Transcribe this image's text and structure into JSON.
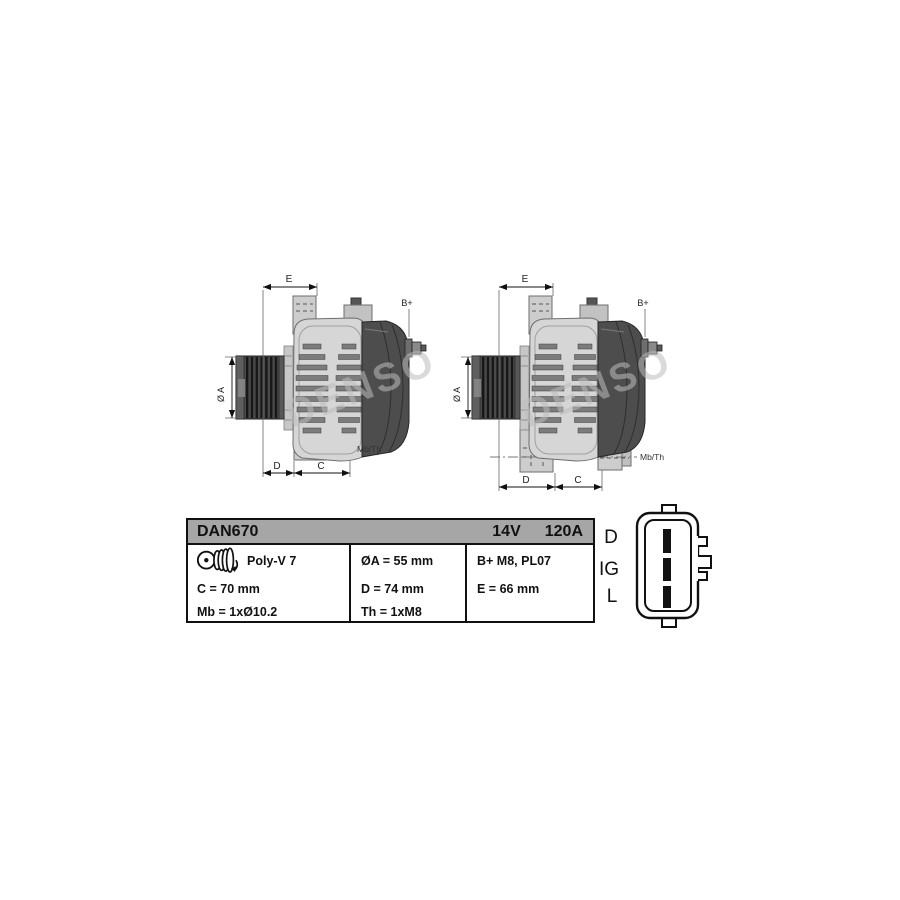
{
  "drawing_labels": {
    "e": "E",
    "d": "D",
    "c": "C",
    "dia": "Ø A",
    "bplus": "B+",
    "mbth": "Mb/Th",
    "watermark": "DENSO"
  },
  "table": {
    "part_number": "DAN670",
    "voltage": "14V",
    "amperage": "120A",
    "pulley_type": "Poly-V 7",
    "cells": {
      "oa": "ØA = 55 mm",
      "c": "C = 70 mm",
      "d": "D = 74 mm",
      "e": "E = 66 mm",
      "mb": "Mb = 1xØ10.2",
      "th": "Th = 1xM8",
      "bplus": "B+ M8, PL07"
    }
  },
  "connector": {
    "pin_labels": [
      "D",
      "IG",
      "L"
    ]
  },
  "colors": {
    "table_header_bg": "#a6a6a6",
    "drawing_body_gray": "#d6d6d6",
    "rear_cover_gray": "#4d4d4d",
    "pulley_gray": "#4a4a4a",
    "watermark_gray": "#bdbdbd"
  }
}
